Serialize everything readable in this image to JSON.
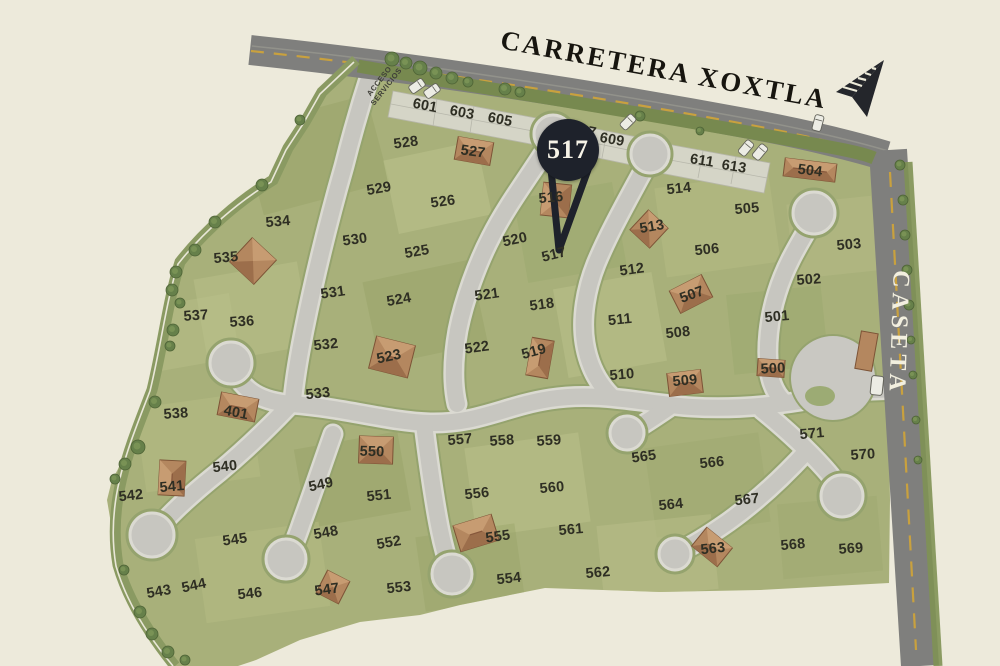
{
  "map": {
    "road_title": "CARRETERA XOXTLA",
    "gate_label": "CASETA",
    "access": {
      "line1": "ACCESO",
      "line2": "SERVICIOS"
    },
    "marker": {
      "label": "517",
      "color": "#1e222b",
      "text_color": "#f6f3e7"
    },
    "colors": {
      "background": "#edeadb",
      "grass": "#a8b07a",
      "road": "#c7c6c0",
      "highway": "#7f7f7d",
      "lane_line": "#c9a13e",
      "house": "#b4875f",
      "label_text": "#2e2e23"
    },
    "lots": [
      {
        "n": "601",
        "x": 425,
        "y": 106,
        "r": 11
      },
      {
        "n": "603",
        "x": 462,
        "y": 113,
        "r": 11
      },
      {
        "n": "605",
        "x": 500,
        "y": 120,
        "r": 11
      },
      {
        "n": "607",
        "x": 584,
        "y": 131,
        "r": 11
      },
      {
        "n": "609",
        "x": 612,
        "y": 140,
        "r": 10
      },
      {
        "n": "611",
        "x": 702,
        "y": 161,
        "r": 9
      },
      {
        "n": "613",
        "x": 734,
        "y": 167,
        "r": 9
      },
      {
        "n": "514",
        "x": 679,
        "y": 189,
        "r": -6
      },
      {
        "n": "505",
        "x": 747,
        "y": 209,
        "r": -5
      },
      {
        "n": "504",
        "x": 810,
        "y": 171,
        "r": 7
      },
      {
        "n": "503",
        "x": 849,
        "y": 245,
        "r": -5
      },
      {
        "n": "506",
        "x": 707,
        "y": 250,
        "r": -6
      },
      {
        "n": "513",
        "x": 652,
        "y": 227,
        "r": -10
      },
      {
        "n": "512",
        "x": 632,
        "y": 270,
        "r": -8
      },
      {
        "n": "502",
        "x": 809,
        "y": 280,
        "r": -4
      },
      {
        "n": "516",
        "x": 551,
        "y": 198,
        "r": -5
      },
      {
        "n": "520",
        "x": 515,
        "y": 240,
        "r": -12
      },
      {
        "n": "517",
        "x": 554,
        "y": 255,
        "r": -14
      },
      {
        "n": "511",
        "x": 620,
        "y": 320,
        "r": -6
      },
      {
        "n": "501",
        "x": 777,
        "y": 317,
        "r": -5
      },
      {
        "n": "508",
        "x": 678,
        "y": 333,
        "r": -6
      },
      {
        "n": "507",
        "x": 692,
        "y": 295,
        "r": -20
      },
      {
        "n": "510",
        "x": 622,
        "y": 375,
        "r": -5
      },
      {
        "n": "509",
        "x": 685,
        "y": 381,
        "r": -5
      },
      {
        "n": "500",
        "x": 773,
        "y": 369,
        "r": -3
      },
      {
        "n": "528",
        "x": 406,
        "y": 143,
        "r": -8
      },
      {
        "n": "527",
        "x": 473,
        "y": 152,
        "r": 8
      },
      {
        "n": "529",
        "x": 379,
        "y": 189,
        "r": -10
      },
      {
        "n": "526",
        "x": 443,
        "y": 202,
        "r": -8
      },
      {
        "n": "525",
        "x": 417,
        "y": 252,
        "r": -10
      },
      {
        "n": "524",
        "x": 399,
        "y": 300,
        "r": -10
      },
      {
        "n": "521",
        "x": 487,
        "y": 295,
        "r": -8
      },
      {
        "n": "518",
        "x": 542,
        "y": 305,
        "r": -8
      },
      {
        "n": "522",
        "x": 477,
        "y": 348,
        "r": -8
      },
      {
        "n": "519",
        "x": 534,
        "y": 352,
        "r": -15
      },
      {
        "n": "523",
        "x": 389,
        "y": 357,
        "r": -12
      },
      {
        "n": "530",
        "x": 355,
        "y": 240,
        "r": -8
      },
      {
        "n": "531",
        "x": 333,
        "y": 293,
        "r": -8
      },
      {
        "n": "532",
        "x": 326,
        "y": 345,
        "r": -6
      },
      {
        "n": "533",
        "x": 318,
        "y": 394,
        "r": -6
      },
      {
        "n": "534",
        "x": 278,
        "y": 222,
        "r": -5
      },
      {
        "n": "535",
        "x": 226,
        "y": 258,
        "r": -5
      },
      {
        "n": "536",
        "x": 242,
        "y": 322,
        "r": -4
      },
      {
        "n": "537",
        "x": 196,
        "y": 316,
        "r": -4
      },
      {
        "n": "538",
        "x": 176,
        "y": 414,
        "r": -4
      },
      {
        "n": "401",
        "x": 236,
        "y": 413,
        "r": 11
      },
      {
        "n": "540",
        "x": 225,
        "y": 467,
        "r": -6
      },
      {
        "n": "541",
        "x": 172,
        "y": 487,
        "r": -5
      },
      {
        "n": "542",
        "x": 131,
        "y": 496,
        "r": -6
      },
      {
        "n": "543",
        "x": 159,
        "y": 592,
        "r": -10
      },
      {
        "n": "544",
        "x": 194,
        "y": 586,
        "r": -12
      },
      {
        "n": "545",
        "x": 235,
        "y": 540,
        "r": -8
      },
      {
        "n": "546",
        "x": 250,
        "y": 594,
        "r": -6
      },
      {
        "n": "547",
        "x": 327,
        "y": 590,
        "r": -8
      },
      {
        "n": "548",
        "x": 326,
        "y": 533,
        "r": -10
      },
      {
        "n": "549",
        "x": 321,
        "y": 485,
        "r": -12
      },
      {
        "n": "550",
        "x": 372,
        "y": 452,
        "r": 2
      },
      {
        "n": "551",
        "x": 379,
        "y": 496,
        "r": -6
      },
      {
        "n": "552",
        "x": 389,
        "y": 543,
        "r": -10
      },
      {
        "n": "553",
        "x": 399,
        "y": 588,
        "r": -6
      },
      {
        "n": "554",
        "x": 509,
        "y": 579,
        "r": -6
      },
      {
        "n": "555",
        "x": 498,
        "y": 537,
        "r": -8
      },
      {
        "n": "556",
        "x": 477,
        "y": 494,
        "r": -6
      },
      {
        "n": "557",
        "x": 460,
        "y": 440,
        "r": -5
      },
      {
        "n": "558",
        "x": 502,
        "y": 441,
        "r": -4
      },
      {
        "n": "559",
        "x": 549,
        "y": 441,
        "r": -4
      },
      {
        "n": "560",
        "x": 552,
        "y": 488,
        "r": -5
      },
      {
        "n": "561",
        "x": 571,
        "y": 530,
        "r": -5
      },
      {
        "n": "562",
        "x": 598,
        "y": 573,
        "r": -5
      },
      {
        "n": "563",
        "x": 713,
        "y": 549,
        "r": -6
      },
      {
        "n": "564",
        "x": 671,
        "y": 505,
        "r": -6
      },
      {
        "n": "565",
        "x": 644,
        "y": 457,
        "r": -8
      },
      {
        "n": "566",
        "x": 712,
        "y": 463,
        "r": -6
      },
      {
        "n": "567",
        "x": 747,
        "y": 500,
        "r": -6
      },
      {
        "n": "568",
        "x": 793,
        "y": 545,
        "r": -5
      },
      {
        "n": "569",
        "x": 851,
        "y": 549,
        "r": -4
      },
      {
        "n": "570",
        "x": 863,
        "y": 455,
        "r": -4
      },
      {
        "n": "571",
        "x": 812,
        "y": 434,
        "r": -5
      }
    ],
    "houses": [
      {
        "lot": "527",
        "x": 474,
        "y": 151,
        "w": 36,
        "h": 23,
        "r": 10
      },
      {
        "lot": "516",
        "x": 556,
        "y": 200,
        "w": 28,
        "h": 33,
        "r": 6
      },
      {
        "lot": "513",
        "x": 649,
        "y": 229,
        "w": 27,
        "h": 27,
        "r": 43
      },
      {
        "lot": "504",
        "x": 810,
        "y": 170,
        "w": 52,
        "h": 18,
        "r": 7
      },
      {
        "lot": "507",
        "x": 691,
        "y": 294,
        "w": 36,
        "h": 25,
        "r": -27
      },
      {
        "lot": "509",
        "x": 685,
        "y": 383,
        "w": 34,
        "h": 23,
        "r": -7
      },
      {
        "lot": "500",
        "x": 771,
        "y": 368,
        "w": 27,
        "h": 17,
        "r": 4
      },
      {
        "lot": "523",
        "x": 392,
        "y": 357,
        "w": 40,
        "h": 33,
        "r": 14
      },
      {
        "lot": "519",
        "x": 540,
        "y": 358,
        "w": 22,
        "h": 38,
        "r": 10
      },
      {
        "lot": "535",
        "x": 253,
        "y": 261,
        "w": 33,
        "h": 33,
        "r": 43
      },
      {
        "lot": "401",
        "x": 238,
        "y": 407,
        "w": 38,
        "h": 23,
        "r": 11
      },
      {
        "lot": "541",
        "x": 172,
        "y": 478,
        "w": 26,
        "h": 35,
        "r": 3
      },
      {
        "lot": "550",
        "x": 376,
        "y": 450,
        "w": 34,
        "h": 27,
        "r": 2
      },
      {
        "lot": "555",
        "x": 476,
        "y": 533,
        "w": 40,
        "h": 27,
        "r": -17
      },
      {
        "lot": "547",
        "x": 333,
        "y": 587,
        "w": 25,
        "h": 25,
        "r": 27
      },
      {
        "lot": "563",
        "x": 712,
        "y": 547,
        "w": 33,
        "h": 24,
        "r": 39
      }
    ]
  }
}
